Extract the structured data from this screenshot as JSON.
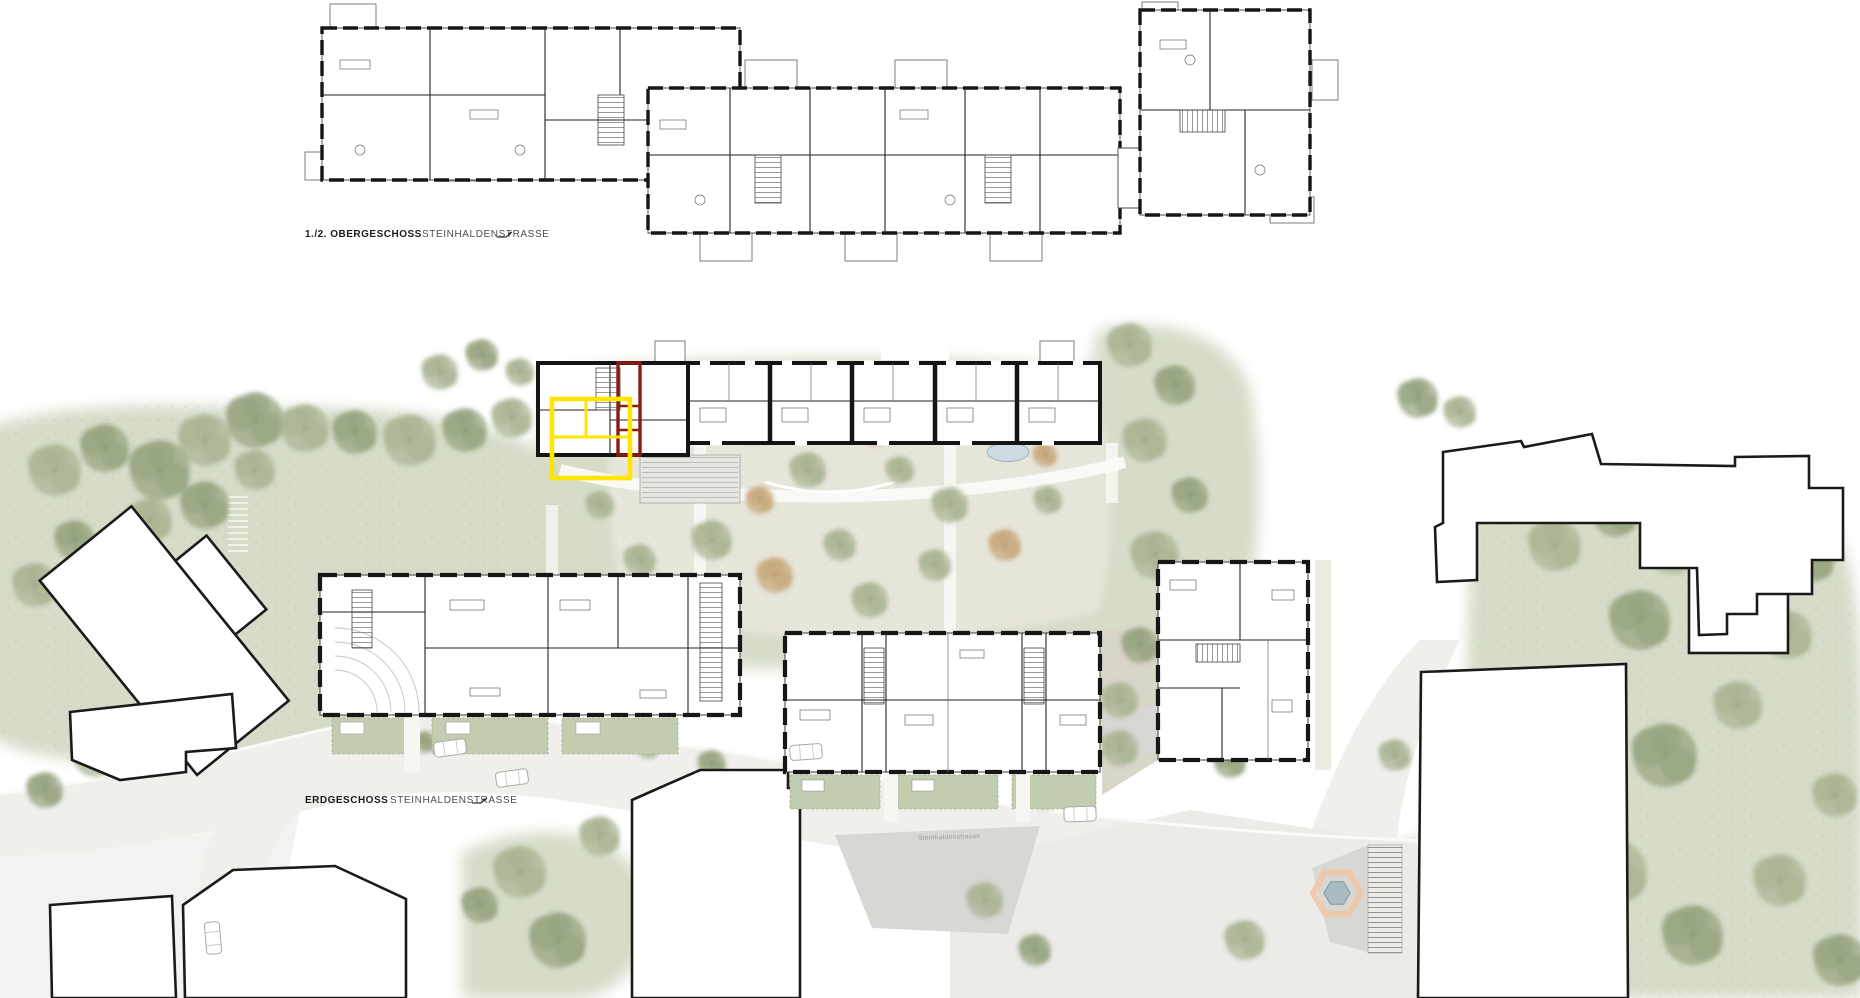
{
  "labels": {
    "upper_plan": {
      "bold": "1./2. OBERGESCHOSS",
      "street": "STEINHALDENSTRASSE"
    },
    "ground_plan": {
      "bold": "ERDGESCHOSS",
      "street": "STEINHALDENSTRASSE"
    },
    "street_name": "Steinhaldenstrasse"
  },
  "colors": {
    "paper": "#ffffff",
    "ink": "#161616",
    "landscape": "#d6dcc8",
    "plaza": "#e9e7dd",
    "street": "#f0efec",
    "gravel": "#d9d5c7",
    "hedge": "#c2ccae",
    "shadow": "#d8d7d3",
    "tree_sage": "#a9b493",
    "tree_dark": "#96a37f",
    "tree_tan": "#c8a87c",
    "water": "#cddce4",
    "water_edge": "#8fb0c0",
    "highlight_yellow": "#ffe500",
    "highlight_red": "#8a1d12",
    "canopy": "#e6e6e2",
    "path_white": "#fafaf8"
  },
  "trees": [
    {
      "x": 55,
      "y": 470,
      "r": 26,
      "c": "sage"
    },
    {
      "x": 105,
      "y": 448,
      "r": 24,
      "c": "dark"
    },
    {
      "x": 160,
      "y": 470,
      "r": 30,
      "c": "dark"
    },
    {
      "x": 205,
      "y": 440,
      "r": 26,
      "c": "sage"
    },
    {
      "x": 255,
      "y": 420,
      "r": 28,
      "c": "dark"
    },
    {
      "x": 305,
      "y": 428,
      "r": 24,
      "c": "sage"
    },
    {
      "x": 355,
      "y": 432,
      "r": 22,
      "c": "dark"
    },
    {
      "x": 410,
      "y": 440,
      "r": 26,
      "c": "sage"
    },
    {
      "x": 465,
      "y": 430,
      "r": 22,
      "c": "dark"
    },
    {
      "x": 512,
      "y": 418,
      "r": 20,
      "c": "sage"
    },
    {
      "x": 205,
      "y": 505,
      "r": 24,
      "c": "dark"
    },
    {
      "x": 150,
      "y": 520,
      "r": 22,
      "c": "sage"
    },
    {
      "x": 75,
      "y": 540,
      "r": 20,
      "c": "dark"
    },
    {
      "x": 35,
      "y": 585,
      "r": 22,
      "c": "sage"
    },
    {
      "x": 255,
      "y": 470,
      "r": 20,
      "c": "sage"
    },
    {
      "x": 440,
      "y": 372,
      "r": 18,
      "c": "sage"
    },
    {
      "x": 482,
      "y": 355,
      "r": 16,
      "c": "dark"
    },
    {
      "x": 520,
      "y": 372,
      "r": 14,
      "c": "sage"
    },
    {
      "x": 648,
      "y": 428,
      "r": 16,
      "c": "sage"
    },
    {
      "x": 700,
      "y": 415,
      "r": 18,
      "c": "tan"
    },
    {
      "x": 752,
      "y": 428,
      "r": 16,
      "c": "sage"
    },
    {
      "x": 808,
      "y": 470,
      "r": 18,
      "c": "sage"
    },
    {
      "x": 760,
      "y": 500,
      "r": 14,
      "c": "tan"
    },
    {
      "x": 712,
      "y": 540,
      "r": 20,
      "c": "sage"
    },
    {
      "x": 775,
      "y": 575,
      "r": 18,
      "c": "tan"
    },
    {
      "x": 840,
      "y": 545,
      "r": 16,
      "c": "sage"
    },
    {
      "x": 876,
      "y": 430,
      "r": 16,
      "c": "tan"
    },
    {
      "x": 900,
      "y": 470,
      "r": 14,
      "c": "sage"
    },
    {
      "x": 950,
      "y": 505,
      "r": 18,
      "c": "sage"
    },
    {
      "x": 1005,
      "y": 545,
      "r": 16,
      "c": "tan"
    },
    {
      "x": 1048,
      "y": 500,
      "r": 14,
      "c": "sage"
    },
    {
      "x": 935,
      "y": 565,
      "r": 16,
      "c": "sage"
    },
    {
      "x": 992,
      "y": 430,
      "r": 14,
      "c": "sage"
    },
    {
      "x": 1045,
      "y": 455,
      "r": 12,
      "c": "tan"
    },
    {
      "x": 870,
      "y": 600,
      "r": 18,
      "c": "sage"
    },
    {
      "x": 640,
      "y": 560,
      "r": 16,
      "c": "sage"
    },
    {
      "x": 600,
      "y": 505,
      "r": 14,
      "c": "sage"
    },
    {
      "x": 1130,
      "y": 345,
      "r": 22,
      "c": "sage"
    },
    {
      "x": 1175,
      "y": 385,
      "r": 20,
      "c": "dark"
    },
    {
      "x": 1145,
      "y": 440,
      "r": 22,
      "c": "sage"
    },
    {
      "x": 1190,
      "y": 495,
      "r": 18,
      "c": "dark"
    },
    {
      "x": 1155,
      "y": 555,
      "r": 24,
      "c": "sage"
    },
    {
      "x": 1200,
      "y": 610,
      "r": 20,
      "c": "sage"
    },
    {
      "x": 1140,
      "y": 645,
      "r": 18,
      "c": "dark"
    },
    {
      "x": 1185,
      "y": 680,
      "r": 16,
      "c": "sage"
    },
    {
      "x": 1120,
      "y": 700,
      "r": 18,
      "c": "sage"
    },
    {
      "x": 352,
      "y": 736,
      "r": 11,
      "c": "sage"
    },
    {
      "x": 425,
      "y": 742,
      "r": 11,
      "c": "dark"
    },
    {
      "x": 600,
      "y": 738,
      "r": 12,
      "c": "sage"
    },
    {
      "x": 648,
      "y": 748,
      "r": 11,
      "c": "sage"
    },
    {
      "x": 800,
      "y": 790,
      "r": 11,
      "c": "sage"
    },
    {
      "x": 905,
      "y": 793,
      "r": 11,
      "c": "dark"
    },
    {
      "x": 1045,
      "y": 798,
      "r": 12,
      "c": "sage"
    },
    {
      "x": 712,
      "y": 764,
      "r": 14,
      "c": "dark"
    },
    {
      "x": 1060,
      "y": 722,
      "r": 14,
      "c": "tan"
    },
    {
      "x": 1120,
      "y": 748,
      "r": 18,
      "c": "sage"
    },
    {
      "x": 1418,
      "y": 398,
      "r": 20,
      "c": "dark"
    },
    {
      "x": 1460,
      "y": 412,
      "r": 16,
      "c": "sage"
    },
    {
      "x": 1555,
      "y": 545,
      "r": 26,
      "c": "sage"
    },
    {
      "x": 1615,
      "y": 515,
      "r": 22,
      "c": "dark"
    },
    {
      "x": 1672,
      "y": 548,
      "r": 26,
      "c": "sage"
    },
    {
      "x": 1640,
      "y": 620,
      "r": 30,
      "c": "dark"
    },
    {
      "x": 1595,
      "y": 695,
      "r": 26,
      "c": "sage"
    },
    {
      "x": 1665,
      "y": 755,
      "r": 32,
      "c": "dark"
    },
    {
      "x": 1738,
      "y": 705,
      "r": 24,
      "c": "sage"
    },
    {
      "x": 1788,
      "y": 635,
      "r": 24,
      "c": "sage"
    },
    {
      "x": 1812,
      "y": 560,
      "r": 22,
      "c": "dark"
    },
    {
      "x": 1755,
      "y": 553,
      "r": 18,
      "c": "sage"
    },
    {
      "x": 1545,
      "y": 805,
      "r": 28,
      "c": "dark"
    },
    {
      "x": 1615,
      "y": 872,
      "r": 32,
      "c": "sage"
    },
    {
      "x": 1693,
      "y": 935,
      "r": 30,
      "c": "dark"
    },
    {
      "x": 1780,
      "y": 880,
      "r": 26,
      "c": "sage"
    },
    {
      "x": 1835,
      "y": 795,
      "r": 22,
      "c": "sage"
    },
    {
      "x": 1500,
      "y": 940,
      "r": 26,
      "c": "sage"
    },
    {
      "x": 1578,
      "y": 975,
      "r": 24,
      "c": "dark"
    },
    {
      "x": 1840,
      "y": 960,
      "r": 26,
      "c": "dark"
    },
    {
      "x": 95,
      "y": 755,
      "r": 22,
      "c": "sage"
    },
    {
      "x": 45,
      "y": 790,
      "r": 18,
      "c": "dark"
    },
    {
      "x": 150,
      "y": 738,
      "r": 16,
      "c": "sage"
    },
    {
      "x": 262,
      "y": 925,
      "r": 22,
      "c": "sage"
    },
    {
      "x": 305,
      "y": 975,
      "r": 24,
      "c": "dark"
    },
    {
      "x": 520,
      "y": 872,
      "r": 26,
      "c": "sage"
    },
    {
      "x": 558,
      "y": 940,
      "r": 28,
      "c": "dark"
    },
    {
      "x": 600,
      "y": 836,
      "r": 20,
      "c": "sage"
    },
    {
      "x": 480,
      "y": 905,
      "r": 18,
      "c": "dark"
    },
    {
      "x": 985,
      "y": 900,
      "r": 18,
      "c": "sage"
    },
    {
      "x": 1035,
      "y": 950,
      "r": 16,
      "c": "dark"
    },
    {
      "x": 1245,
      "y": 940,
      "r": 20,
      "c": "sage"
    },
    {
      "x": 1230,
      "y": 762,
      "r": 16,
      "c": "dark"
    },
    {
      "x": 1395,
      "y": 755,
      "r": 16,
      "c": "sage"
    }
  ],
  "cars": [
    {
      "x": 450,
      "y": 748,
      "rot": -8
    },
    {
      "x": 512,
      "y": 778,
      "rot": -8
    },
    {
      "x": 806,
      "y": 752,
      "rot": -4
    },
    {
      "x": 1080,
      "y": 814,
      "rot": -2
    },
    {
      "x": 213,
      "y": 938,
      "rot": 85
    }
  ]
}
